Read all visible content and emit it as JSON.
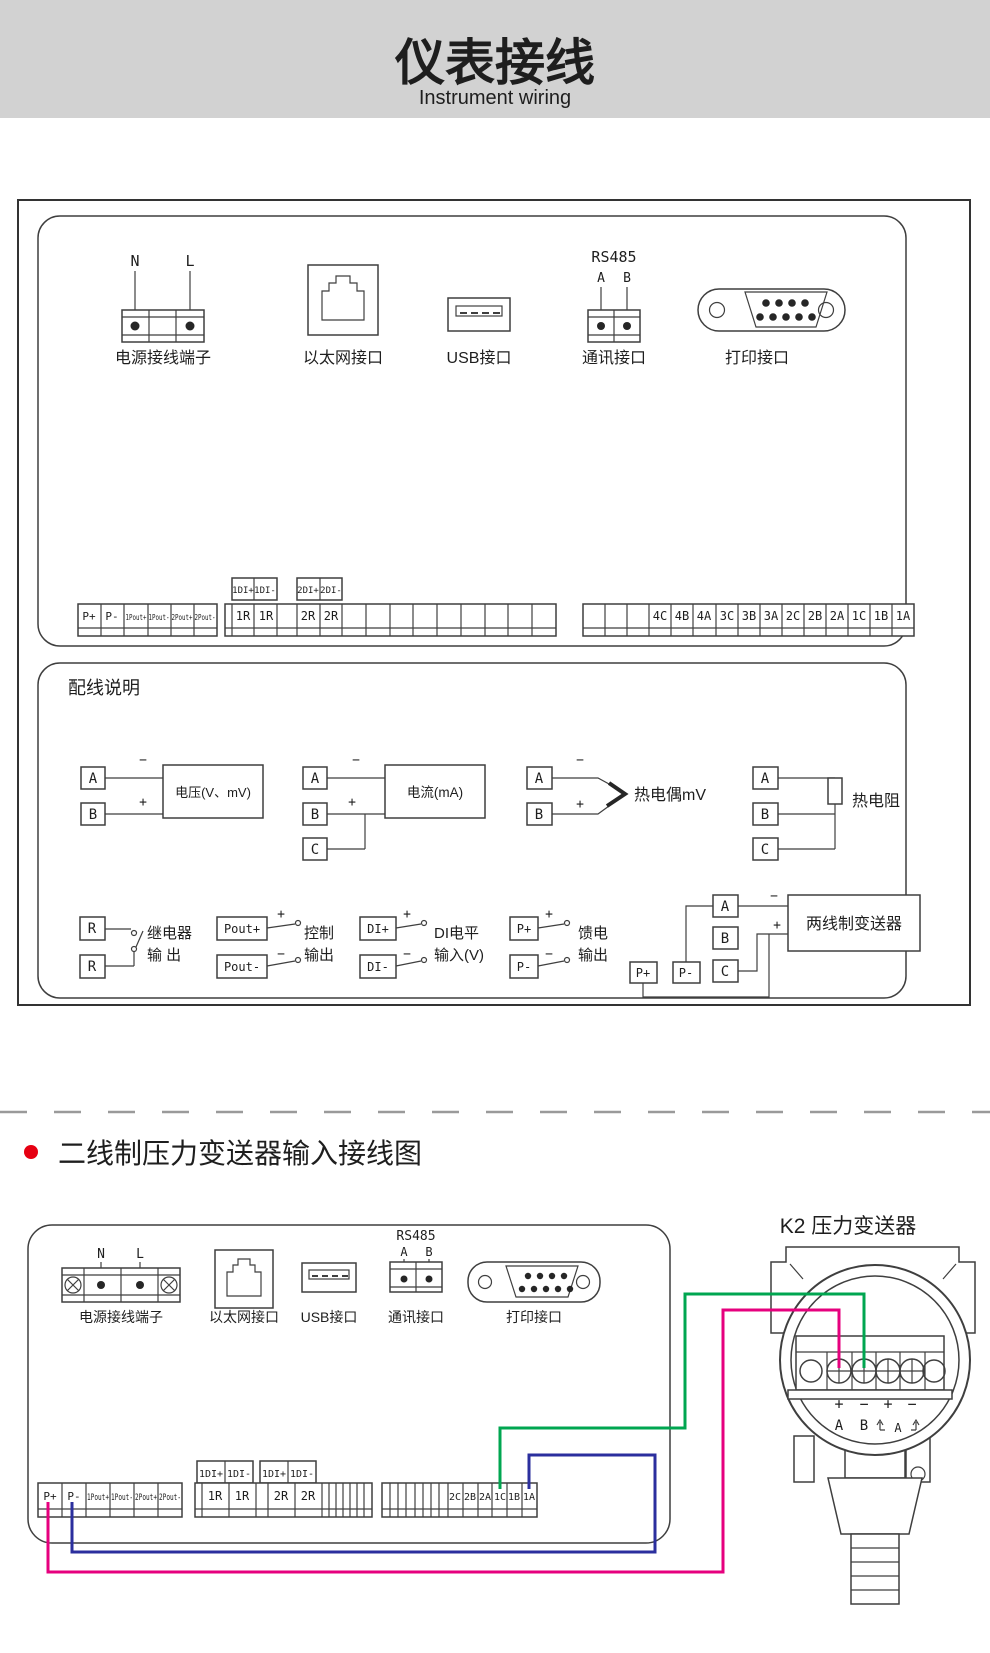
{
  "banner": {
    "bg": "#d2d2d2",
    "title_zh": "仪表接线",
    "title_en": "Instrument wiring"
  },
  "panel_ports": {
    "power_label": "电源接线端子",
    "power_n": "N",
    "power_l": "L",
    "ethernet_label": "以太网接口",
    "usb_label": "USB接口",
    "comm_label": "通讯接口",
    "comm_bus": "RS485",
    "comm_a": "A",
    "comm_b": "B",
    "printer_label": "打印接口"
  },
  "strips_top": {
    "left": [
      "P+",
      "P-",
      "1Pout+",
      "1Pout-",
      "2Pout+",
      "2Pout-"
    ],
    "di1": [
      "1DI+",
      "1DI-"
    ],
    "di2": [
      "2DI+",
      "2DI-"
    ],
    "mid": [
      "1R",
      "1R",
      "2R",
      "2R"
    ],
    "right": [
      "4C",
      "4B",
      "4A",
      "3C",
      "3B",
      "3A",
      "2C",
      "2B",
      "2A",
      "1C",
      "1B",
      "1A"
    ]
  },
  "wiring": {
    "heading": "配线说明",
    "plus": "+",
    "minus": "−",
    "voltage": {
      "a": "A",
      "b": "B",
      "label": "电压(V、mV)"
    },
    "current": {
      "a": "A",
      "b": "B",
      "c": "C",
      "label": "电流(mA)"
    },
    "tc": {
      "a": "A",
      "b": "B",
      "label": "热电偶mV"
    },
    "rtd": {
      "a": "A",
      "b": "B",
      "c": "C",
      "label": "热电阻"
    },
    "relay": {
      "r1": "R",
      "r2": "R",
      "line1": "继电器",
      "line2": "输  出"
    },
    "ctrl": {
      "t1": "Pout+",
      "t2": "Pout-",
      "line1": "控制",
      "line2": "输出"
    },
    "di": {
      "t1": "DI+",
      "t2": "DI-",
      "line1": "DI电平",
      "line2": "输入(V)"
    },
    "feed": {
      "t1": "P+",
      "t2": "P-",
      "line1": "馈电",
      "line2": "输出"
    },
    "two_wire": {
      "a": "A",
      "b": "B",
      "c": "C",
      "p1": "P+",
      "p2": "P-",
      "label": "两线制变送器"
    }
  },
  "section2_title": "二线制压力变送器输入接线图",
  "strips_bottom": {
    "left": [
      "P+",
      "P-",
      "1Pout+",
      "1Pout-",
      "2Pout+",
      "2Pout-"
    ],
    "di1": [
      "1DI+",
      "1DI-"
    ],
    "di2": [
      "1DI+",
      "1DI-"
    ],
    "mid": [
      "1R",
      "1R",
      "2R",
      "2R"
    ],
    "right": [
      "2C",
      "2B",
      "2A",
      "1C",
      "1B",
      "1A"
    ]
  },
  "transmitter": {
    "label": "K2 压力变送器",
    "t1": "+",
    "t2": "−",
    "t3": "+",
    "t4": "−",
    "a": "A",
    "b": "B",
    "loop_a": "A"
  },
  "colors": {
    "wire_feed_plus": "#e6007e",
    "wire_feed_minus": "#2b2f9e",
    "wire_signal": "#00a650",
    "accent_bullet": "#e60012"
  }
}
